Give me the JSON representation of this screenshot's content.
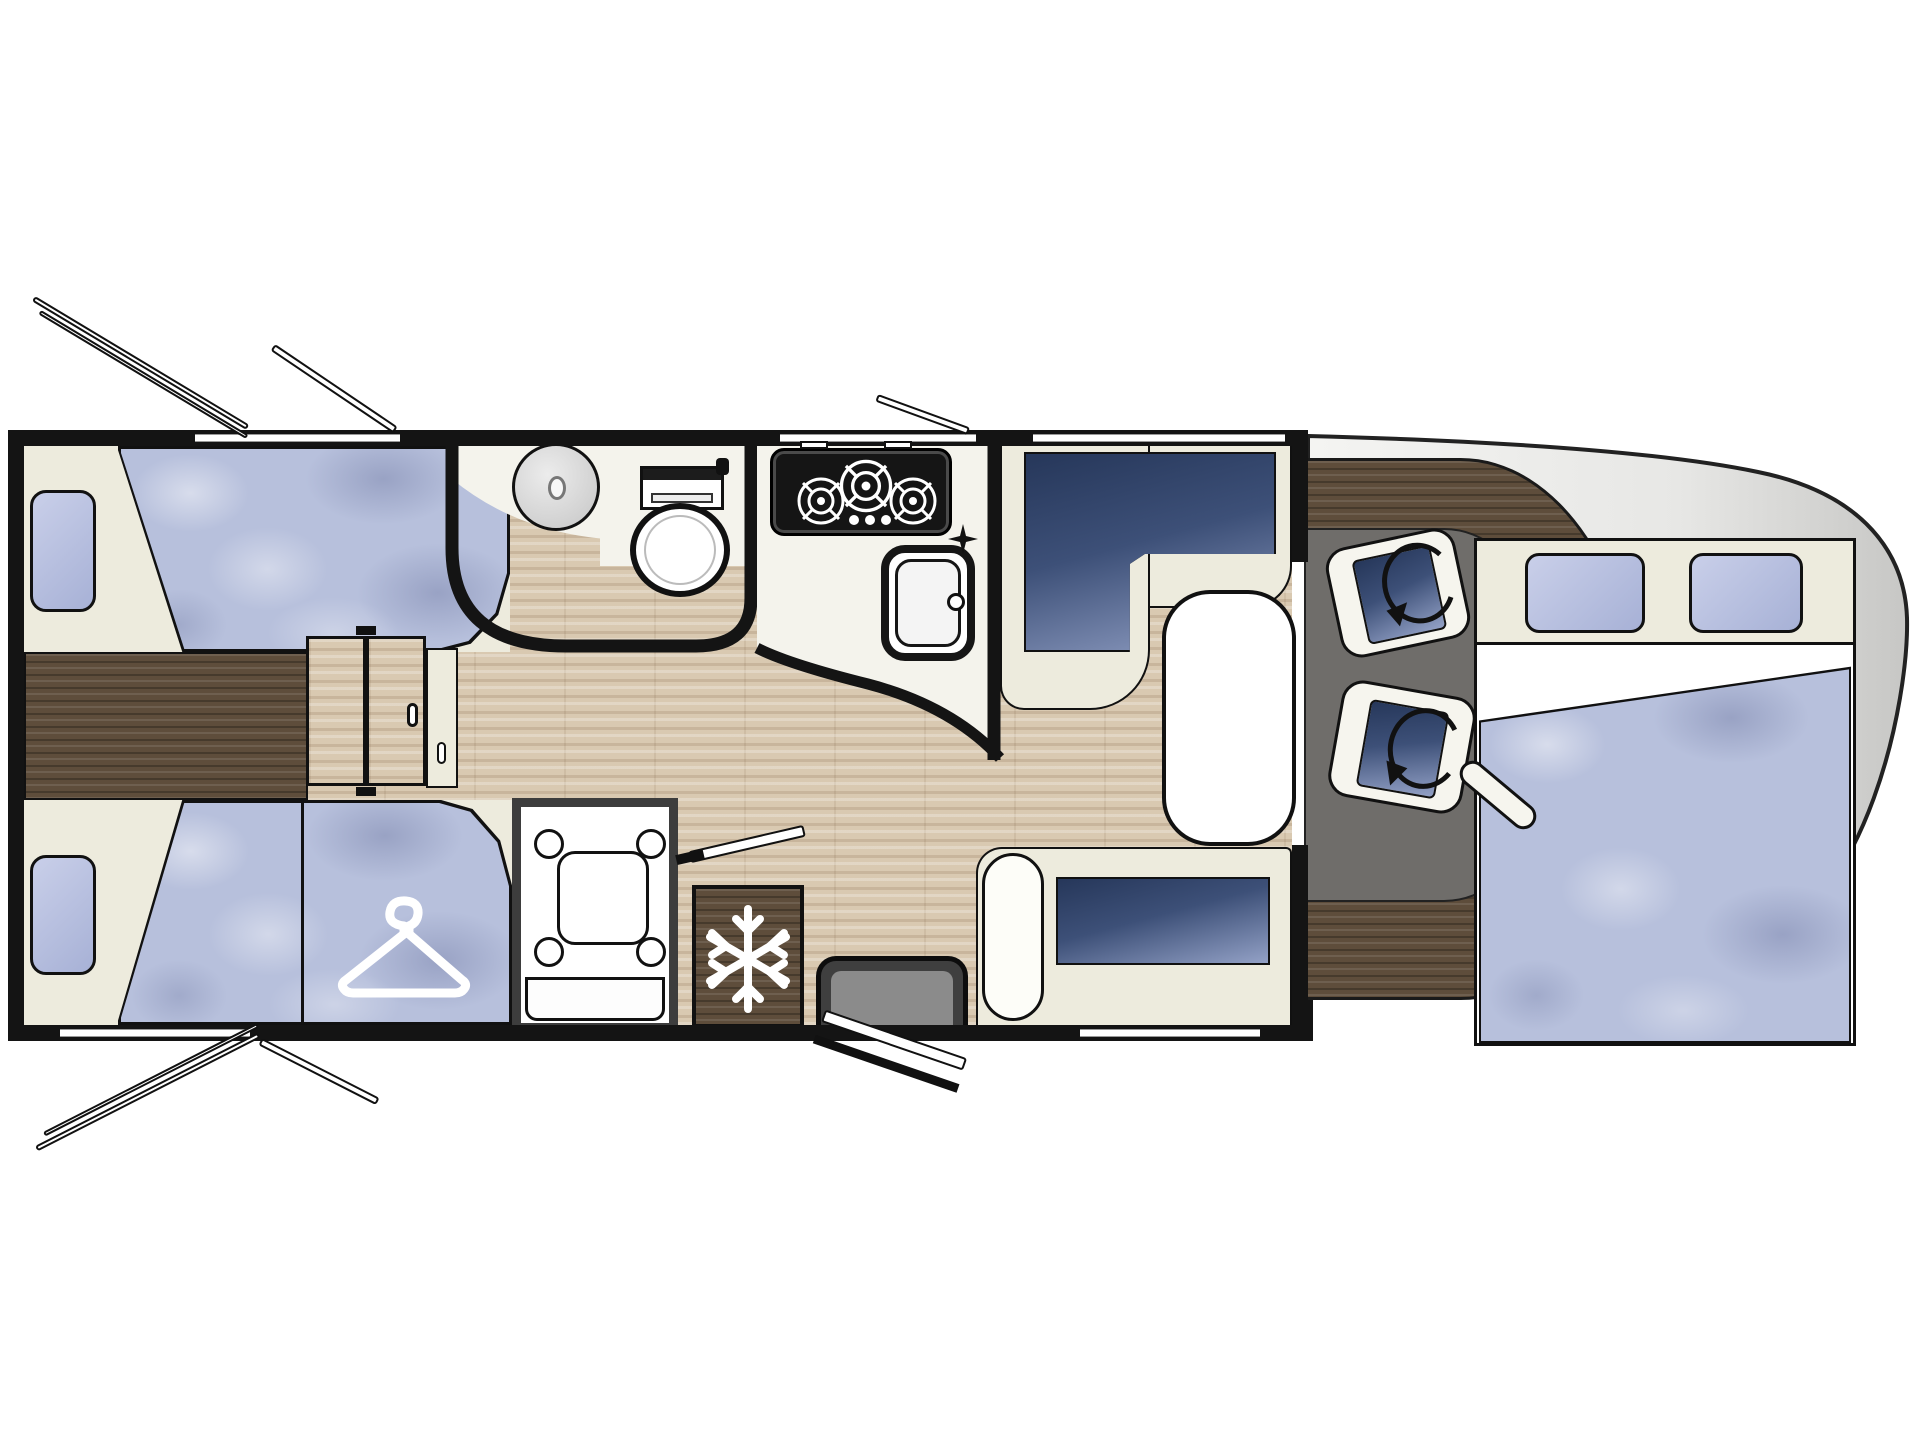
{
  "diagram": {
    "type": "motorhome-floor-plan-top-view",
    "orientation": "cab-front-right, rear-left",
    "elements": {
      "vehicle-body": "cab body shell with rounded nose",
      "dashboard": "dark wood dashboard ring around cab",
      "cab-floor": "grey cab floor",
      "swivel-seat-front": "rotated cab seat with swivel arrow",
      "swivel-seat-rear": "rotated cab seat with swivel arrow",
      "dropdown-bed": "over-cab drop-down double bed with two pillows and folded sheet",
      "dinette-l-seat": "L-shaped dinette bench with navy cushion",
      "dinette-table": "white oval dinette table",
      "side-bench": "side bench seat with navy cushion",
      "entry-step": "entrance step at habitation door",
      "entry-door": "open entrance door leaf",
      "kitchen-hob": "3-burner gas hob",
      "kitchen-sink": "rectangular kitchen sink with tap",
      "bathroom": "washroom with round basin and toilet",
      "shower": "separate shower cubicle",
      "fridge": "refrigerator (snowflake icon)",
      "wardrobe": "wardrobe with clothes-hanger icon",
      "bed-rear-top": "single bed, rear offside",
      "bed-rear-bottom": "single bed, rear nearside",
      "chest": "dark wood chest between rear beds",
      "sliding-door": "two-panel sliding partition door",
      "windows": "side and wall windows with open flap vents"
    },
    "icons": [
      "hanger-icon",
      "snowflake-icon",
      "rotation-arrow-icon",
      "burner-icon",
      "tap-cross-icon"
    ]
  },
  "colors": {
    "wall": "#141414",
    "cream": "#edebdd",
    "wood_light": "#d9c9b1",
    "wood_dark": "#5e4d3b",
    "window_pane_1": "#c9cfe9",
    "window_pane_2": "#a7b1d6",
    "cushion_navy_1": "#2c3d60",
    "cushion_navy_2": "#93a1c6",
    "mattress_blue": "#b7c0dc",
    "cab_floor_grey": "#6f6d6a",
    "body_grey_1": "#f4f4f2",
    "body_grey_2": "#cbcbc9"
  }
}
